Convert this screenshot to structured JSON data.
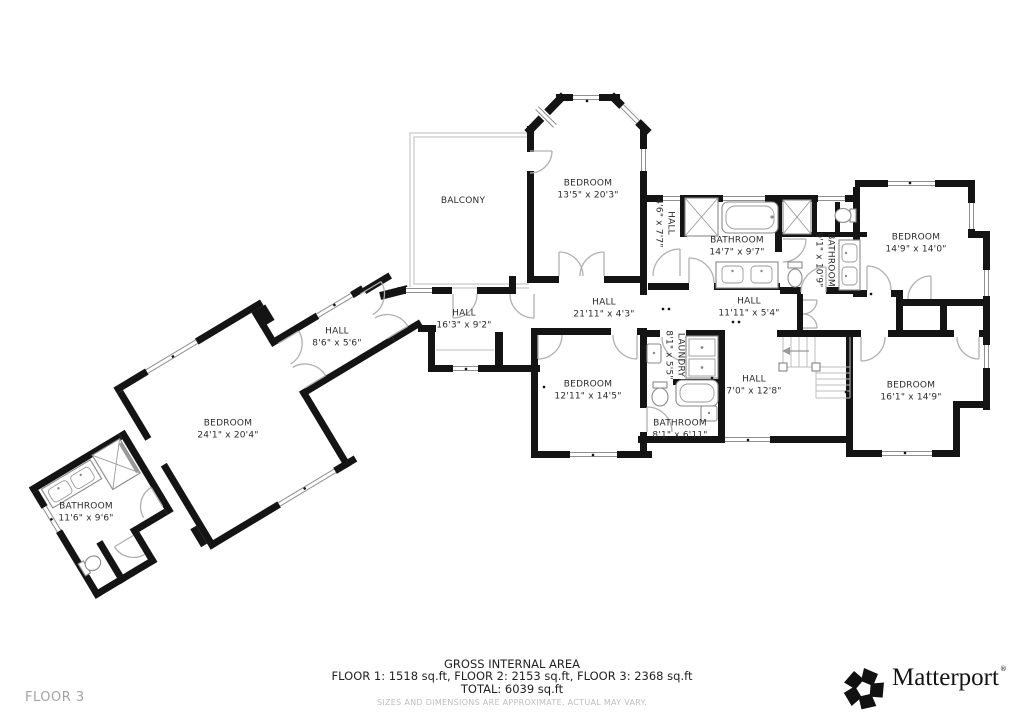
{
  "plan": {
    "floor_label": "FLOOR 3",
    "rooms": {
      "balcony": {
        "name": "BALCONY",
        "dims": ""
      },
      "bedroom_top": {
        "name": "BEDROOM",
        "dims": "13'5\" x 20'3\""
      },
      "hall_small": {
        "name": "HALL",
        "dims": "4'6\" x 7'7\""
      },
      "bathroom_main": {
        "name": "BATHROOM",
        "dims": "14'7\" x 9'7\""
      },
      "bathroom_right": {
        "name": "BATHROOM",
        "dims": "9'1\" x 10'9\""
      },
      "bedroom_right_top": {
        "name": "BEDROOM",
        "dims": "14'9\" x 14'0\""
      },
      "hall_long": {
        "name": "HALL",
        "dims": "21'11\" x 4'3\""
      },
      "hall_right": {
        "name": "HALL",
        "dims": "11'11\" x 5'4\""
      },
      "hall_left": {
        "name": "HALL",
        "dims": "16'3\" x 9'2\""
      },
      "hall_diag": {
        "name": "HALL",
        "dims": "8'6\" x 5'6\""
      },
      "bedroom_mid": {
        "name": "BEDROOM",
        "dims": "12'11\" x 14'5\""
      },
      "laundry": {
        "name": "LAUNDRY",
        "dims": "8'1\" x 5'5\""
      },
      "hall_stairs": {
        "name": "HALL",
        "dims": "7'0\" x 12'8\""
      },
      "bedroom_right_bottom": {
        "name": "BEDROOM",
        "dims": "16'1\" x 14'9\""
      },
      "bathroom_mid": {
        "name": "BATHROOM",
        "dims": "8'1\" x 6'11\""
      },
      "bedroom_master": {
        "name": "BEDROOM",
        "dims": "24'1\" x 20'4\""
      },
      "bathroom_master": {
        "name": "BATHROOM",
        "dims": "11'6\" x 9'6\""
      }
    }
  },
  "footer": {
    "title": "GROSS INTERNAL AREA",
    "floors": "FLOOR 1: 1518 sq.ft, FLOOR 2: 2153 sq.ft, FLOOR 3: 2368 sq.ft",
    "total": "TOTAL: 6039 sq.ft",
    "disclaimer": "SIZES AND DIMENSIONS ARE APPROXIMATE, ACTUAL MAY VARY."
  },
  "brand": {
    "name": "Matterport",
    "mark": "®"
  }
}
